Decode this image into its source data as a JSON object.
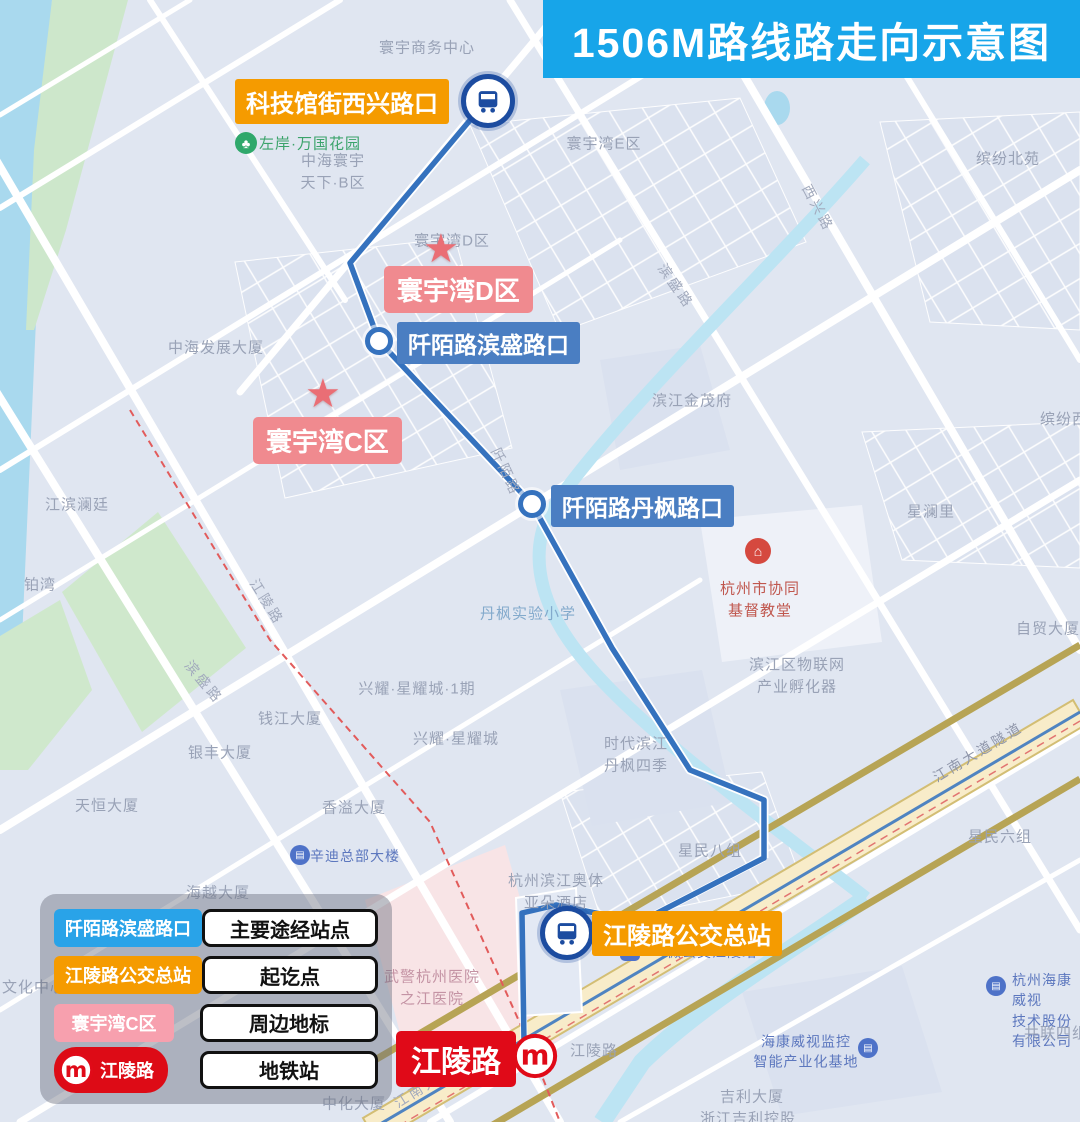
{
  "title": "1506M路线路走向示意图",
  "route": {
    "name": "1506M",
    "stations": {
      "start": "科技馆街西兴路口",
      "stop_binsheng": "阡陌路滨盛路口",
      "stop_danfeng": "阡陌路丹枫路口",
      "terminal": "江陵路公交总站",
      "metro": "江陵路"
    }
  },
  "landmarks": {
    "d": "寰宇湾D区",
    "c": "寰宇湾C区"
  },
  "legend": {
    "station_sample": "阡陌路滨盛路口",
    "station_meaning": "主要途经站点",
    "terminal_sample": "江陵路公交总站",
    "terminal_meaning": "起讫点",
    "landmark_sample": "寰宇湾C区",
    "landmark_meaning": "周边地标",
    "metro_sample": "江陵路",
    "metro_meaning": "地铁站"
  },
  "colors": {
    "title_bg": "#17A5E9",
    "route_line": "#3572BE",
    "station_label_bg": "#4A7EC2",
    "terminal_label_bg": "#F59B00",
    "landmark_label_bg": "#F08A8F",
    "metro_label_bg": "#E00A18",
    "water": "#BCE4F3",
    "highway": "#F8ECC9"
  },
  "map_labels": {
    "huanyu_biz": "寰宇商务中心",
    "huanyu_e": "寰宇湾E区",
    "huanyu_d_map": "寰宇湾D区",
    "binfen_north": "缤纷北苑",
    "zhonghai_tianxia": "中海寰宇\n天下·B区",
    "zuoan_garden": "左岸·万国花园",
    "xixing_rd": "西兴路",
    "binsheng_rd_ne": "滨盛路",
    "zhonghai_tower": "中海发展大厦",
    "jinmaofu": "滨江金茂府",
    "binfen_west": "缤纷西苑",
    "xinglanli": "星澜里",
    "jiangbin_lanting": "江滨澜廷",
    "bowan": "铂湾",
    "danfeng_school": "丹枫实验小学",
    "church": "杭州市协同\n基督教堂",
    "iot_incubator": "滨江区物联网\n产业孵化器",
    "zimao_tower": "自贸大厦",
    "jiangling_rd_label": "江陵路",
    "binsheng_rd_sw": "滨盛路",
    "qianmo_rd": "阡陌路",
    "qianjiang_tower": "钱江大厦",
    "xingyao_phase1": "兴耀·星耀城·1期",
    "xingyao": "兴耀·星耀城",
    "yinfeng_tower": "银丰大厦",
    "shidai_danfeng": "时代滨江\n丹枫四季",
    "jiangnan_tunnel": "江南大道隧道",
    "xingmin8": "星民八组",
    "xingmin6": "星民六组",
    "tianheng_tower": "天恒大厦",
    "xiangyi_tower": "香溢大厦",
    "xindi_hq": "辛迪总部大楼",
    "haiyue_tower": "海越大厦",
    "aoti_hotel": "杭州滨江奥体\n亚朵酒店",
    "culture_center": "文化中心",
    "hospital": "武警杭州医院\n之江医院",
    "micro_bus": "微公交江陵站",
    "zhonghua_tower": "中化大厦",
    "jiangnan_ave": "江南大道",
    "jiangling_rd_small": "江陵路",
    "hikvision_base": "海康威视监控\n智能产业化基地",
    "hikvision_co": "杭州海康威视\n技术股份有限公司",
    "gonglian4": "共联四组",
    "geely_tower": "吉利大厦",
    "geely_holding": "浙江吉利控股"
  }
}
